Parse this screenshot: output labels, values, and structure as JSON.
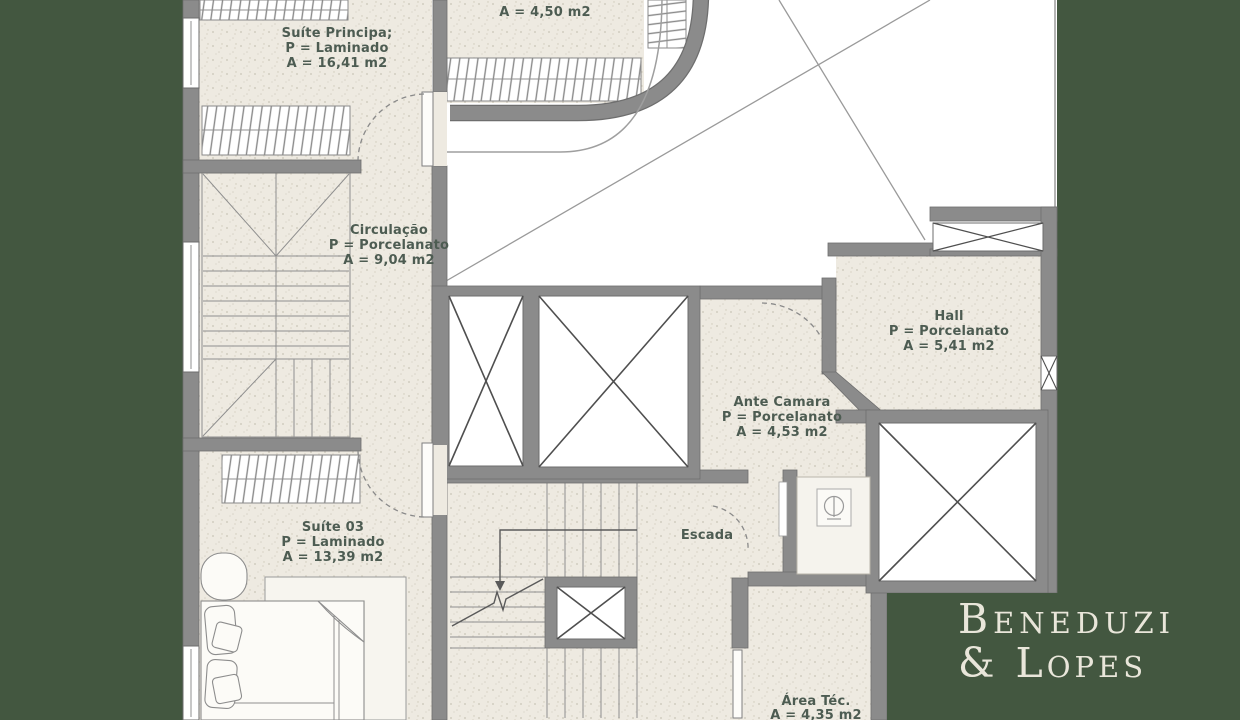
{
  "rooms": {
    "closet": {
      "area": "A = 4,50 m2"
    },
    "suite_principal": {
      "name": "Suíte Principa;",
      "floor": "P = Laminado",
      "area": "A = 16,41 m2"
    },
    "circulacao": {
      "name": "Circulação",
      "floor": "P = Porcelanato",
      "area": "A = 9,04 m2"
    },
    "hall": {
      "name": "Hall",
      "floor": "P = Porcelanato",
      "area": "A = 5,41 m2"
    },
    "ante_camara": {
      "name": "Ante Camara",
      "floor": "P = Porcelanato",
      "area": "A = 4,53 m2"
    },
    "suite_03": {
      "name": "Suíte 03",
      "floor": "P = Laminado",
      "area": "A = 13,39 m2"
    },
    "escada": {
      "name": "Escada"
    },
    "area_tecnica": {
      "name": "Área Téc.",
      "area": "A = 4,35 m2"
    }
  },
  "brand": {
    "line1": "Beneduzi",
    "line2": "& Lopes"
  },
  "colors": {
    "background_green": "#435740",
    "floor_beige": "#eeeae1",
    "wall_gray": "#8b8b8b",
    "label_green": "#4d5c52",
    "logo_cream": "#e9e6da",
    "void_white": "#ffffff"
  }
}
